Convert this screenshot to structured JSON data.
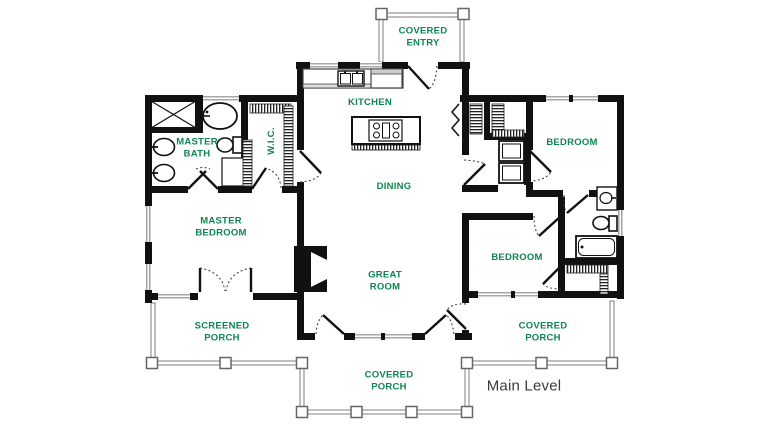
{
  "title": "Main Level floor plan",
  "colors": {
    "label_green": "#0f8552",
    "wall_black": "#111111",
    "rail_gray": "#8a8a8a",
    "level_text": "#3a3a3a"
  },
  "rooms": {
    "covered_entry": "COVERED\nENTRY",
    "kitchen": "KITCHEN",
    "master_bath": "MASTER\nBATH",
    "wic": "W.I.C.",
    "dining": "DINING",
    "bedroom_top": "BEDROOM",
    "master_bedroom": "MASTER\nBEDROOM",
    "great_room": "GREAT\nROOM",
    "bedroom_bottom": "BEDROOM",
    "screened_porch": "SCREENED\nPORCH",
    "covered_porch_right": "COVERED\nPORCH",
    "covered_porch_bottom": "COVERED\nPORCH",
    "level_label": "Main Level"
  },
  "symbols": [
    "shower",
    "freestanding-tub",
    "double-vanity-sinks",
    "toilet",
    "walk-in-closet-rods",
    "linen-cabinet",
    "kitchen-counter-double-sink",
    "island-cooktop",
    "refrigerator",
    "washer-dryer",
    "fireplace",
    "hall-bathtub",
    "hall-vanity-sink",
    "porch-railing-posts",
    "french-doors",
    "bifold-closet-door"
  ]
}
